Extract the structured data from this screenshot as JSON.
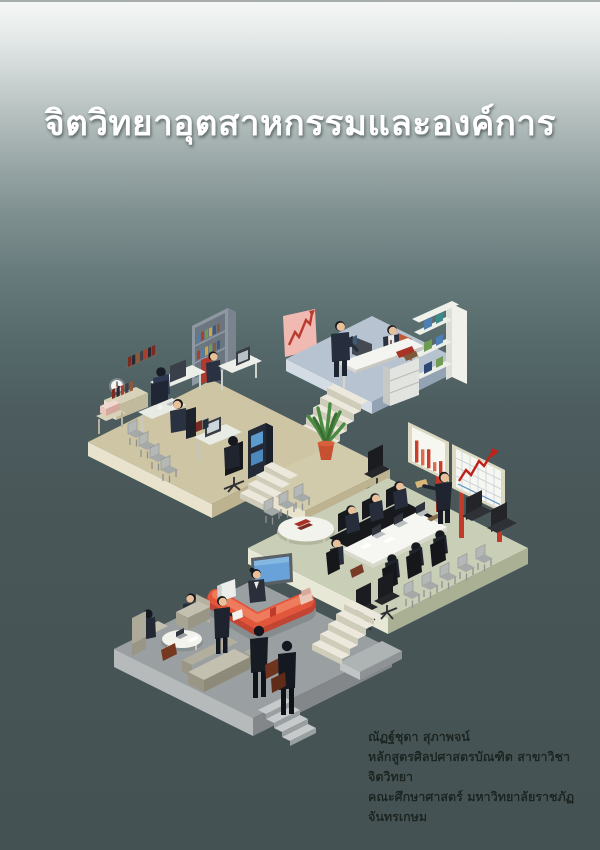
{
  "cover": {
    "title": "จิตวิทยาอุตสาหกรรมและองค์การ",
    "author_block": {
      "lines": [
        "ณัฏฐ์ชุดา สุภาพจน์",
        "หลักสูตรศิลปศาสตรบัณฑิต สาขาวิชาจิตวิทยา",
        "คณะศึกษาศาสตร์ มหาวิทยาลัยราชภัฏจันทรเกษม"
      ]
    },
    "illustration": {
      "description": "isometric-office-scenes-illustration",
      "scenes": [
        "staff-office",
        "executive-office",
        "meeting-room",
        "reception-lobby"
      ],
      "palette": {
        "background_top": "#f5f7f6",
        "background_bottom": "#445254",
        "title_color": "#ffffff",
        "platform_tan": "#cdc5a4",
        "platform_blue": "#b7c3d0",
        "platform_green": "#c9cfb6",
        "platform_gray": "#9aa0a2",
        "counter_red": "#cc4732",
        "poster_pink": "#f0b9b2",
        "chart_red": "#c8402c",
        "screen_blue": "#68a2d8",
        "plant_green": "#4a8a42",
        "pot_orange": "#c6502f",
        "suit_dark": "#20252f"
      }
    }
  }
}
